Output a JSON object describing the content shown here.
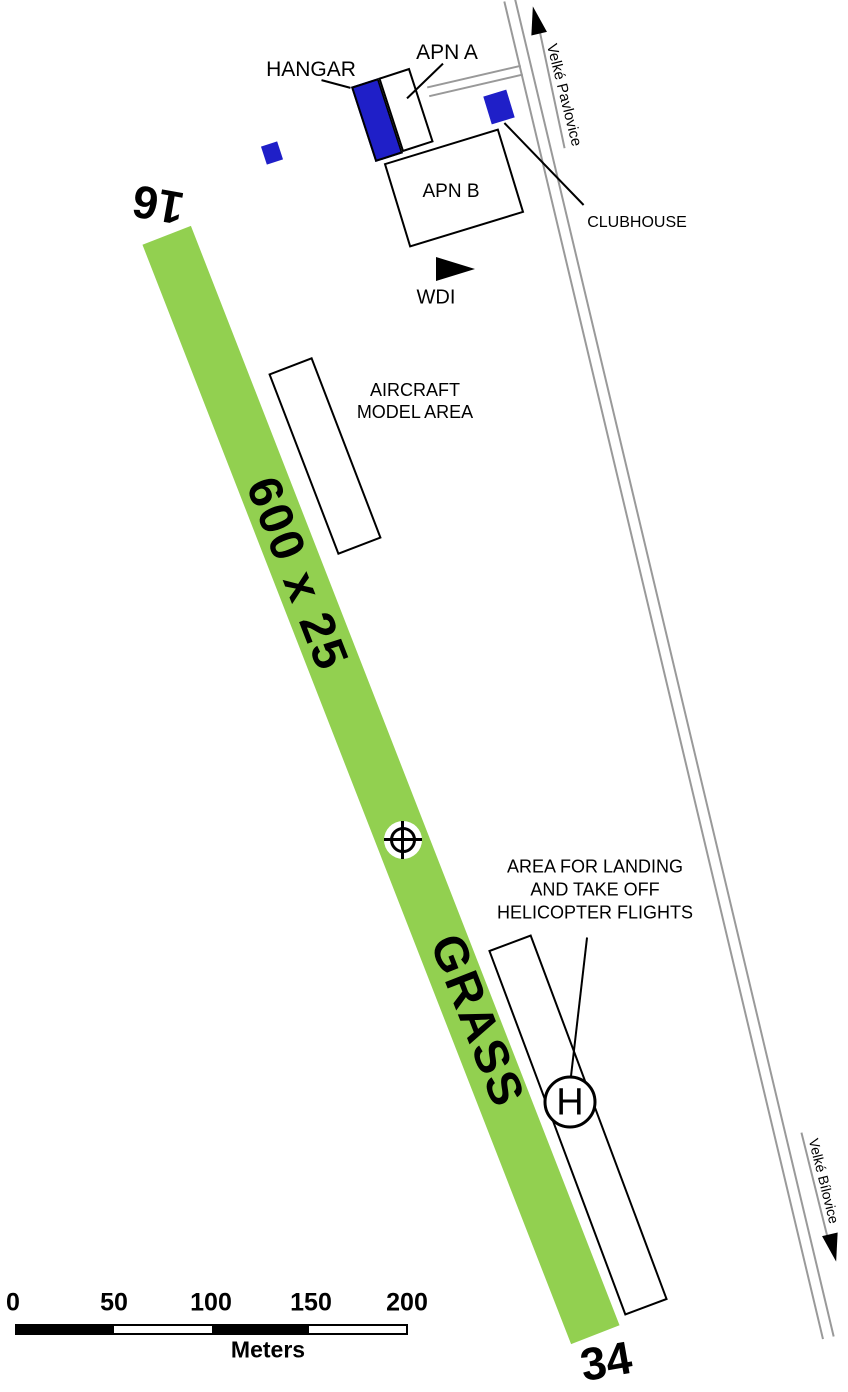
{
  "runway": {
    "designator_16": "16",
    "designator_34": "34",
    "size_label": "600 x 25",
    "surface_label": "GRASS"
  },
  "apron": {
    "hangar_label": "HANGAR",
    "apn_a_label": "APN A",
    "apn_b_label": "APN B",
    "clubhouse_label": "CLUBHOUSE"
  },
  "wdi": {
    "label": "WDI"
  },
  "model_area": {
    "line1": "AIRCRAFT",
    "line2": "MODEL AREA"
  },
  "heli_area": {
    "line1": "AREA FOR LANDING",
    "line2": "AND TAKE OFF",
    "line3": "HELICOPTER FLIGHTS",
    "pad_letter": "H"
  },
  "roads": {
    "to_north_label": "Velké Pavlovice",
    "to_south_label": "Velké Bílovice"
  },
  "scale_bar": {
    "ticks": [
      "0",
      "50",
      "100",
      "150",
      "200"
    ],
    "unit": "Meters"
  },
  "colors": {
    "runway_green": "#92D050",
    "building_blue": "#1F1FC8",
    "road_gray": "#999999"
  },
  "icons": {
    "arp": "crosshair-circle",
    "wdi": "right-pointing-triangle",
    "road_north_arrow": "up-arrow",
    "road_south_arrow": "down-arrow",
    "helipad": "circled-letter-H"
  }
}
